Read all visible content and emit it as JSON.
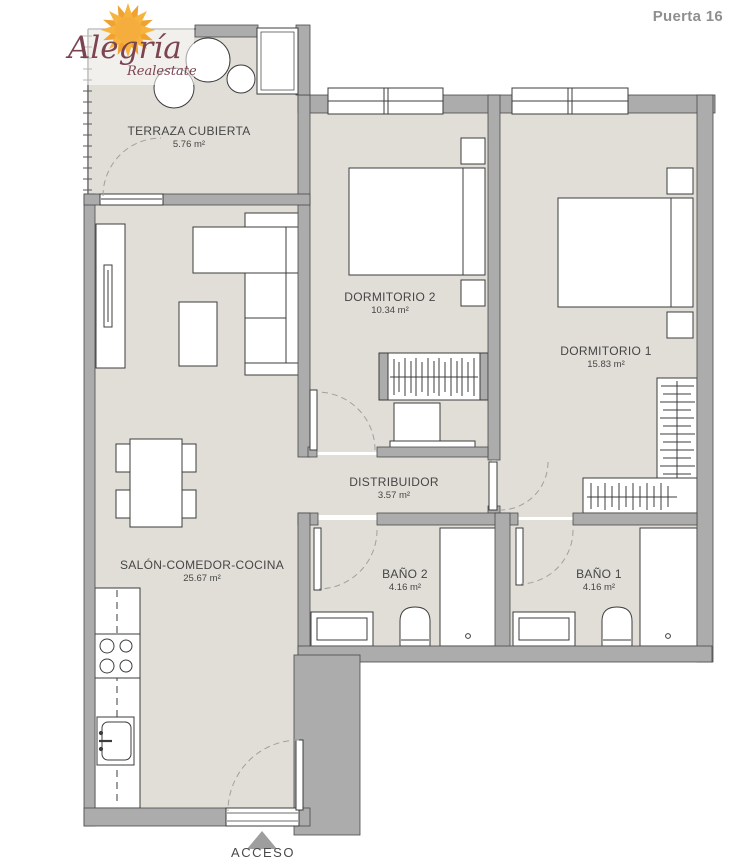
{
  "header": {
    "unit_label": "Puerta 16"
  },
  "logo": {
    "brand": "Alegría",
    "subtitle": "Realestate"
  },
  "plan": {
    "rooms": [
      {
        "id": "terraza",
        "name": "TERRAZA CUBIERTA",
        "area": "5.76 m²"
      },
      {
        "id": "dormitorio2",
        "name": "DORMITORIO 2",
        "area": "10.34 m²"
      },
      {
        "id": "dormitorio1",
        "name": "DORMITORIO 1",
        "area": "15.83 m²"
      },
      {
        "id": "distribuidor",
        "name": "DISTRIBUIDOR",
        "area": "3.57 m²"
      },
      {
        "id": "salon",
        "name": "SALÓN-COMEDOR-COCINA",
        "area": "25.67 m²"
      },
      {
        "id": "bano2",
        "name": "BAÑO 2",
        "area": "4.16 m²"
      },
      {
        "id": "bano1",
        "name": "BAÑO 1",
        "area": "4.16 m²"
      }
    ],
    "entrance_label": "ACCESO",
    "colors": {
      "wall": "#acacac",
      "floor": "#e1ded8",
      "line": "#3c3c3c",
      "door_arc": "#a0a0a0",
      "label_text": "#454545",
      "sun_accent": "#f5a93b",
      "brand_text": "#7c4350",
      "header_text": "#8f8f8f"
    }
  }
}
